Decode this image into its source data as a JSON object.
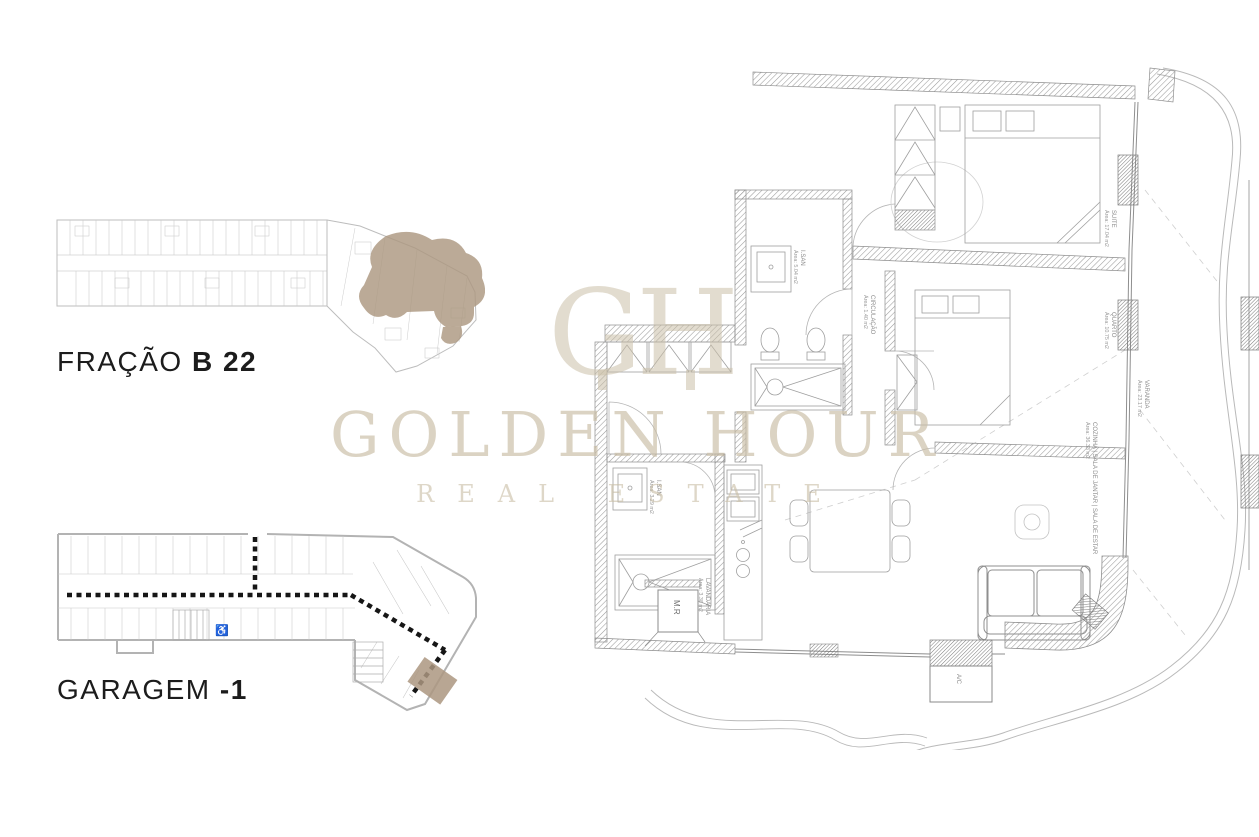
{
  "overview_plan": {
    "caption_light": "FRAÇÃO",
    "caption_bold": "B 22"
  },
  "garage_plan": {
    "caption_light": "GARAGEM",
    "caption_bold": "-1"
  },
  "watermark": {
    "monogram": "GH",
    "line1": "GOLDEN HOUR",
    "line2": "REAL ESTATE",
    "color": "#cbbfa8"
  },
  "colors": {
    "highlight": "#ac9780",
    "wall_hatch": "#999999",
    "dashed_lane": "#161616",
    "plan_line": "#c3c3c3"
  },
  "apartment_plan": {
    "rooms": [
      {
        "name": "SUITE",
        "area": "Área: 17.04 m2"
      },
      {
        "name": "QUARTO",
        "area": "Área: 10.75 m2"
      },
      {
        "name": "I.SAN",
        "area": "Área: 5.04 m2"
      },
      {
        "name": "CIRCULAÇÃO",
        "area": "Área: 1.40 m2"
      },
      {
        "name": "COZINHA | SALA DE JANTAR | SALA DE ESTAR",
        "area": "Área: 36.33 m2"
      },
      {
        "name": "I.SAN",
        "area": "Área: 3.29 m2"
      },
      {
        "name": "LAVANDARIA",
        "area": "Área: 3.38 m2"
      },
      {
        "name": "VARANDA",
        "area": "Área: 23.17 m2"
      },
      {
        "name": "M.R",
        "area": ""
      },
      {
        "name": "A/C",
        "area": ""
      }
    ]
  }
}
